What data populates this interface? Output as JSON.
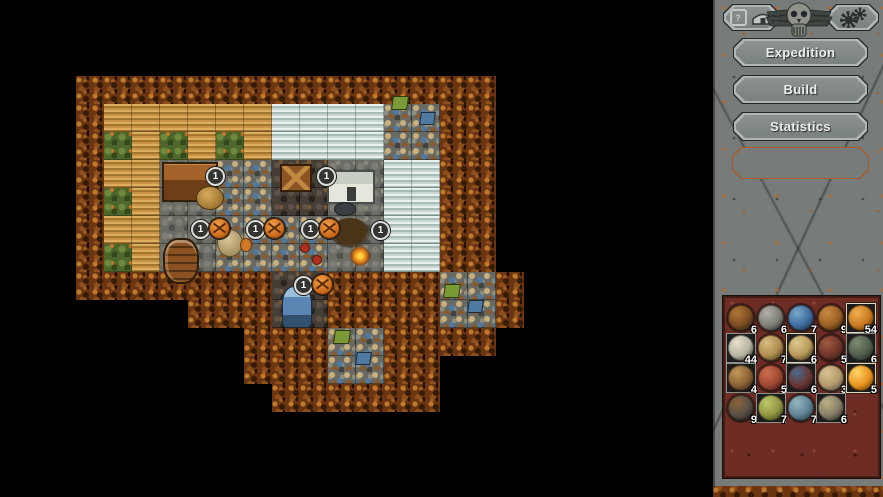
{
  "colors": {
    "bg": "#000000",
    "panel-gray": "#777c7a",
    "button-fill": "#798280",
    "button-fill-light": "#8d918f",
    "button-border": "#b2b6b2",
    "button-outline": "#24282a",
    "text-light": "#eceeea",
    "slot-outline": "#a85a28",
    "inventory-red": "#6e2d24",
    "cell-bg": "#1c1c1c",
    "frame-gray": "#90908a",
    "frame-bright": "#ded8c2",
    "badge-ring": "#dcdcd8",
    "badge-bg": "#333332",
    "badge-orange": "#cf6e1e"
  },
  "sidebar": {
    "help_button": {
      "label": "?",
      "icon": "shelter-icon"
    },
    "settings_button": {
      "icon": "gear-icon"
    },
    "emblem": "skull-wings-emblem",
    "menu_buttons": [
      {
        "label": "Expedition"
      },
      {
        "label": "Build"
      },
      {
        "label": "Statistics"
      }
    ],
    "inventory": {
      "items": [
        {
          "name": "twigs",
          "count": 6,
          "frame": "none",
          "c1": "#7a4a20",
          "c2": "#26201a",
          "c3": "#b07838"
        },
        {
          "name": "stone",
          "count": 6,
          "frame": "none",
          "c1": "#7e7e76",
          "c2": "#2c2c28",
          "c3": "#b0b0a6"
        },
        {
          "name": "blue-ore",
          "count": 7,
          "frame": "none",
          "c1": "#3e6c9e",
          "c2": "#1c2736",
          "c3": "#7aa8cc"
        },
        {
          "name": "roots",
          "count": 9,
          "frame": "none",
          "c1": "#9a5f24",
          "c2": "#2a1c10",
          "c3": "#c98a40"
        },
        {
          "name": "clay-ball",
          "count": 54,
          "frame": "bright",
          "c1": "#c87820",
          "c2": "#4a2808",
          "c3": "#f0b050"
        },
        {
          "name": "skull",
          "count": 44,
          "frame": "gray",
          "c1": "#b8b4a2",
          "c2": "#2e2c24",
          "c3": "#e4e0cc"
        },
        {
          "name": "hide",
          "count": 7,
          "frame": "none",
          "c1": "#b08c50",
          "c2": "#3c2e18",
          "c3": "#d8bc80"
        },
        {
          "name": "scroll",
          "count": 6,
          "frame": "bright",
          "c1": "#b89858",
          "c2": "#32281a",
          "c3": "#dcc890"
        },
        {
          "name": "horn",
          "count": 5,
          "frame": "none",
          "c1": "#6e352a",
          "c2": "#231210",
          "c3": "#a05a40"
        },
        {
          "name": "tools",
          "count": 6,
          "frame": "gray",
          "c1": "#4e5c4a",
          "c2": "#1c221c",
          "c3": "#7e8c74"
        },
        {
          "name": "claw",
          "count": 4,
          "frame": "gray",
          "c1": "#8a6034",
          "c2": "#2a1e12",
          "c3": "#c09858"
        },
        {
          "name": "meat",
          "count": 5,
          "frame": "none",
          "c1": "#9e4630",
          "c2": "#331410",
          "c3": "#cc7050"
        },
        {
          "name": "beetle",
          "count": 6,
          "frame": "gray",
          "c1": "#6a3430",
          "c2": "#1c1216",
          "c3": "#4a6a8e"
        },
        {
          "name": "bone-club",
          "count": 3,
          "frame": "none",
          "c1": "#b49a6a",
          "c2": "#4c4c46",
          "c3": "#d8c394"
        },
        {
          "name": "amber",
          "count": 5,
          "frame": "bright",
          "c1": "#e89420",
          "c2": "#5c3404",
          "c3": "#ffd468"
        },
        {
          "name": "coal",
          "count": 9,
          "frame": "none",
          "c1": "#564f46",
          "c2": "#1a1816",
          "c3": "#8a6438"
        },
        {
          "name": "hops",
          "count": 7,
          "frame": "gray",
          "c1": "#8e9440",
          "c2": "#343a16",
          "c3": "#c0c868"
        },
        {
          "name": "shell",
          "count": 7,
          "frame": "none",
          "c1": "#5e8292",
          "c2": "#22323a",
          "c3": "#94b6c2"
        },
        {
          "name": "gear",
          "count": 6,
          "frame": "gray",
          "c1": "#847c66",
          "c2": "#2a2822",
          "c3": "#beb284"
        }
      ]
    }
  },
  "map": {
    "tile_size": 28,
    "legend": {
      "T": "tree",
      "F": "wheat",
      "G": "bush",
      "I": "ice",
      "C": "clutter",
      "D": "dark",
      "S": "stone",
      "H": "stone",
      "B": "stone"
    },
    "rows": [
      "TTTTTTTTTTTTTTT.",
      "TFFFFFFIIIICCTT.",
      "TGFGFGFIIIICCTT.",
      "TFFHHCCDDSSIITT.",
      "TGFHHCCDDSSIITT.",
      "TFFBBCCCCSSIITT.",
      "TGFBBCCCCSSIITT.",
      "TTTTTTTDDTTTTCCT",
      "....TTTDDTTTTCCT",
      "......TTTCCTTTT.",
      "......TTTCCTT...",
      ".......TTTTTT..."
    ],
    "overlays": [
      {
        "type": "house",
        "x": 86,
        "y": 86,
        "w": 52,
        "h": 36
      },
      {
        "type": "hay",
        "x": 120,
        "y": 110,
        "w": 26,
        "h": 22
      },
      {
        "type": "crate",
        "x": 204,
        "y": 88,
        "w": 28,
        "h": 24
      },
      {
        "type": "icehouse",
        "x": 251,
        "y": 94,
        "w": 44,
        "h": 30
      },
      {
        "type": "dot",
        "x": 258,
        "y": 126,
        "w": 20,
        "h": 12,
        "color": "#3a3e42"
      },
      {
        "type": "barrel",
        "x": 87,
        "y": 162,
        "w": 32,
        "h": 42
      },
      {
        "type": "dome",
        "x": 141,
        "y": 153,
        "w": 24,
        "h": 26
      },
      {
        "type": "dot",
        "x": 164,
        "y": 162,
        "w": 10,
        "h": 12,
        "color": "#d07828"
      },
      {
        "type": "dot",
        "x": 224,
        "y": 167,
        "w": 8,
        "h": 8,
        "color": "#b03020"
      },
      {
        "type": "dot",
        "x": 236,
        "y": 179,
        "w": 8,
        "h": 8,
        "color": "#b03020"
      },
      {
        "type": "treebare",
        "x": 254,
        "y": 142,
        "w": 40,
        "h": 30
      },
      {
        "type": "campfire",
        "x": 274,
        "y": 170,
        "w": 20,
        "h": 20
      },
      {
        "type": "statue",
        "x": 206,
        "y": 210,
        "w": 28,
        "h": 40
      },
      {
        "type": "flaggreen",
        "x": 316,
        "y": 20,
        "w": 14,
        "h": 12
      },
      {
        "type": "flagblue",
        "x": 344,
        "y": 36,
        "w": 13,
        "h": 11
      },
      {
        "type": "flaggreen",
        "x": 368,
        "y": 208,
        "w": 14,
        "h": 12
      },
      {
        "type": "flagblue",
        "x": 392,
        "y": 224,
        "w": 13,
        "h": 11
      },
      {
        "type": "flaggreen",
        "x": 258,
        "y": 254,
        "w": 14,
        "h": 12
      },
      {
        "type": "flagblue",
        "x": 280,
        "y": 276,
        "w": 13,
        "h": 11
      }
    ],
    "badges": [
      {
        "x": 130,
        "y": 91,
        "label": "1",
        "orange": false
      },
      {
        "x": 241,
        "y": 91,
        "label": "1",
        "orange": false
      },
      {
        "x": 115,
        "y": 144,
        "label": "1",
        "orange": true
      },
      {
        "x": 170,
        "y": 144,
        "label": "1",
        "orange": true
      },
      {
        "x": 225,
        "y": 144,
        "label": "1",
        "orange": true
      },
      {
        "x": 295,
        "y": 145,
        "label": "1",
        "orange": false
      },
      {
        "x": 218,
        "y": 200,
        "label": "1",
        "orange": true
      }
    ]
  }
}
